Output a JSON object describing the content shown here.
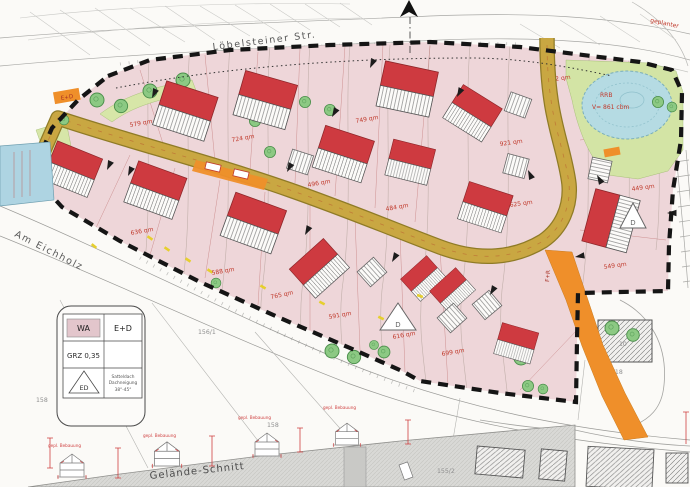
{
  "streets": {
    "top": "Löbelsteiner Str.",
    "left": "Am Eichholz"
  },
  "terrain": {
    "section_label": "Gelände-Schnitt"
  },
  "notes": {
    "planned": "geplanter"
  },
  "basin": {
    "code": "RRB",
    "volume": "V= 861 cbm",
    "green_area": "772 qm"
  },
  "road": {
    "marker": "E+D"
  },
  "path": {
    "label": "F+R"
  },
  "plots": [
    "579 qm",
    "724 qm",
    "749 qm",
    "921 qm",
    "496 qm",
    "484 qm",
    "625 qm",
    "449 qm",
    "549 qm",
    "636 qm",
    "588 qm",
    "765 qm",
    "591 qm",
    "616 qm",
    "699 qm"
  ],
  "parcels": {
    "n156_1": "156/1",
    "n158a": "158",
    "n158b": "158",
    "n155_2": "155/2",
    "n161_18": "161/18",
    "n161": "161",
    "house_no": "10"
  },
  "legend": {
    "use": "WA",
    "storeys": "E+D",
    "grz": "GRZ 0,35",
    "roof_code": "ED",
    "roof_desc": [
      "Satteldach",
      "Dachneigung",
      "38°-45°"
    ]
  },
  "markers": {
    "d1": "D",
    "d2": "D"
  },
  "elevations": {
    "captions": [
      "gepl. Bebauung",
      "gepl. Bebauung",
      "gepl. Bebauung",
      "gepl. Bebauung"
    ]
  }
}
